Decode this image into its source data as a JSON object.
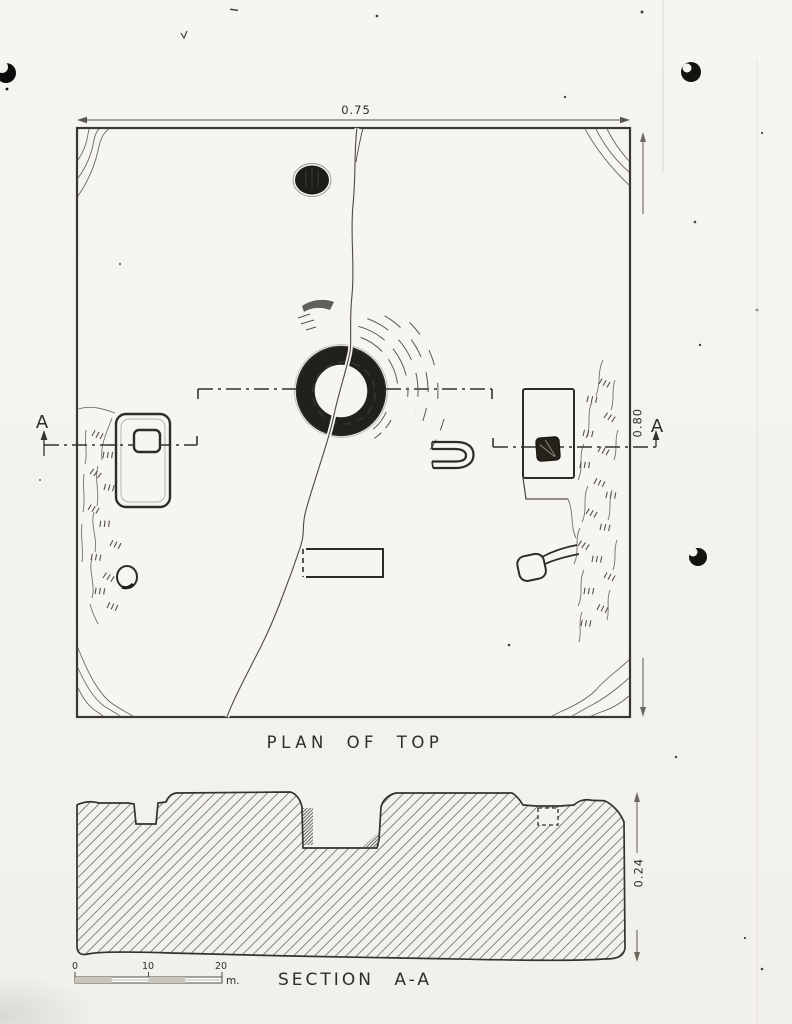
{
  "artifact": {
    "plan": {
      "title": "PLAN OF TOP",
      "width_dim": "0.75",
      "height_dim": "0.80",
      "section_letter_left": "A",
      "section_letter_right": "A"
    },
    "section": {
      "title": "SECTION A-A",
      "thickness_dim": "0.24"
    },
    "scale_bar": {
      "ticks": [
        "0",
        "10",
        "20"
      ],
      "unit": "m."
    },
    "colors": {
      "paper": "#f4f3ef",
      "ink": "#35332d",
      "dark_fill": "#201e1a",
      "hatch": "#807c73"
    }
  }
}
